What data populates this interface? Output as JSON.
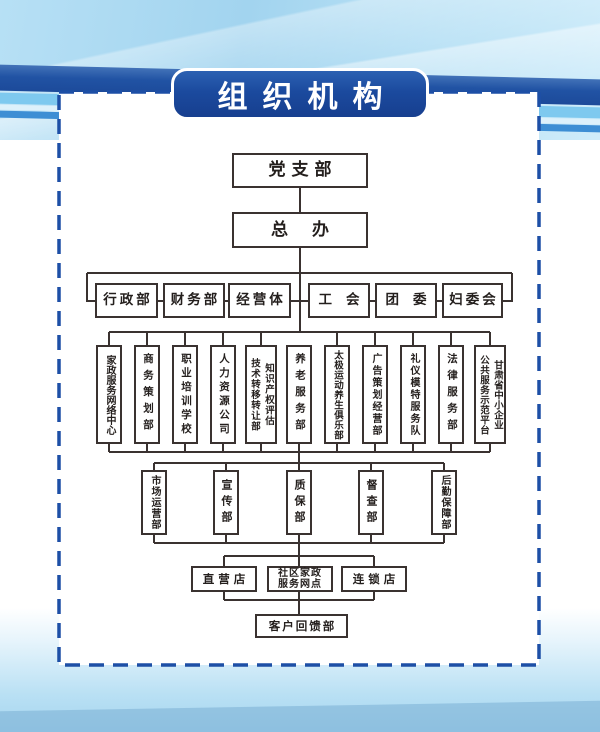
{
  "title_banner": {
    "text": "组织机构"
  },
  "org_chart": {
    "level1": {
      "label": "党支部"
    },
    "level2": {
      "label": "总办"
    },
    "level3": [
      {
        "label": "行政部"
      },
      {
        "label": "财务部"
      },
      {
        "label": "经营体"
      },
      {
        "label": "工会"
      },
      {
        "label": "团委"
      },
      {
        "label": "妇委会"
      }
    ],
    "level4": [
      {
        "label": "家政服务网络中心"
      },
      {
        "label": "商务策划部"
      },
      {
        "label": "职业培训学校"
      },
      {
        "label": "人力资源公司"
      },
      {
        "columns": [
          "知识产权评估",
          "技术转移转让部"
        ]
      },
      {
        "label": "养老服务部"
      },
      {
        "label": "太极运动养生俱乐部"
      },
      {
        "label": "广告策划经营部"
      },
      {
        "label": "礼仪模特服务队"
      },
      {
        "label": "法律服务部"
      },
      {
        "columns": [
          "甘肃省中小企业",
          "公共服务示范平台"
        ]
      }
    ],
    "level5": [
      {
        "label": "市场运营部"
      },
      {
        "label": "宣传部"
      },
      {
        "label": "质保部"
      },
      {
        "label": "督查部"
      },
      {
        "label": "后勤保障部"
      }
    ],
    "level6": {
      "left": {
        "label": "直营店"
      },
      "center": {
        "lines": [
          "社区家政",
          "服务网点"
        ]
      },
      "right": {
        "label": "连锁店"
      }
    },
    "level7": {
      "label": "客户回馈部"
    }
  },
  "colors": {
    "banner_blue": "#1b4a9e",
    "band_blue": "#2153a4",
    "stripe_cyan": "#7ec9ef",
    "stripe_blue": "#3d8ed4",
    "dashed_border": "#1d4fa6",
    "node_border": "#3a3230",
    "background_light_blue": "#a6d6f0"
  }
}
